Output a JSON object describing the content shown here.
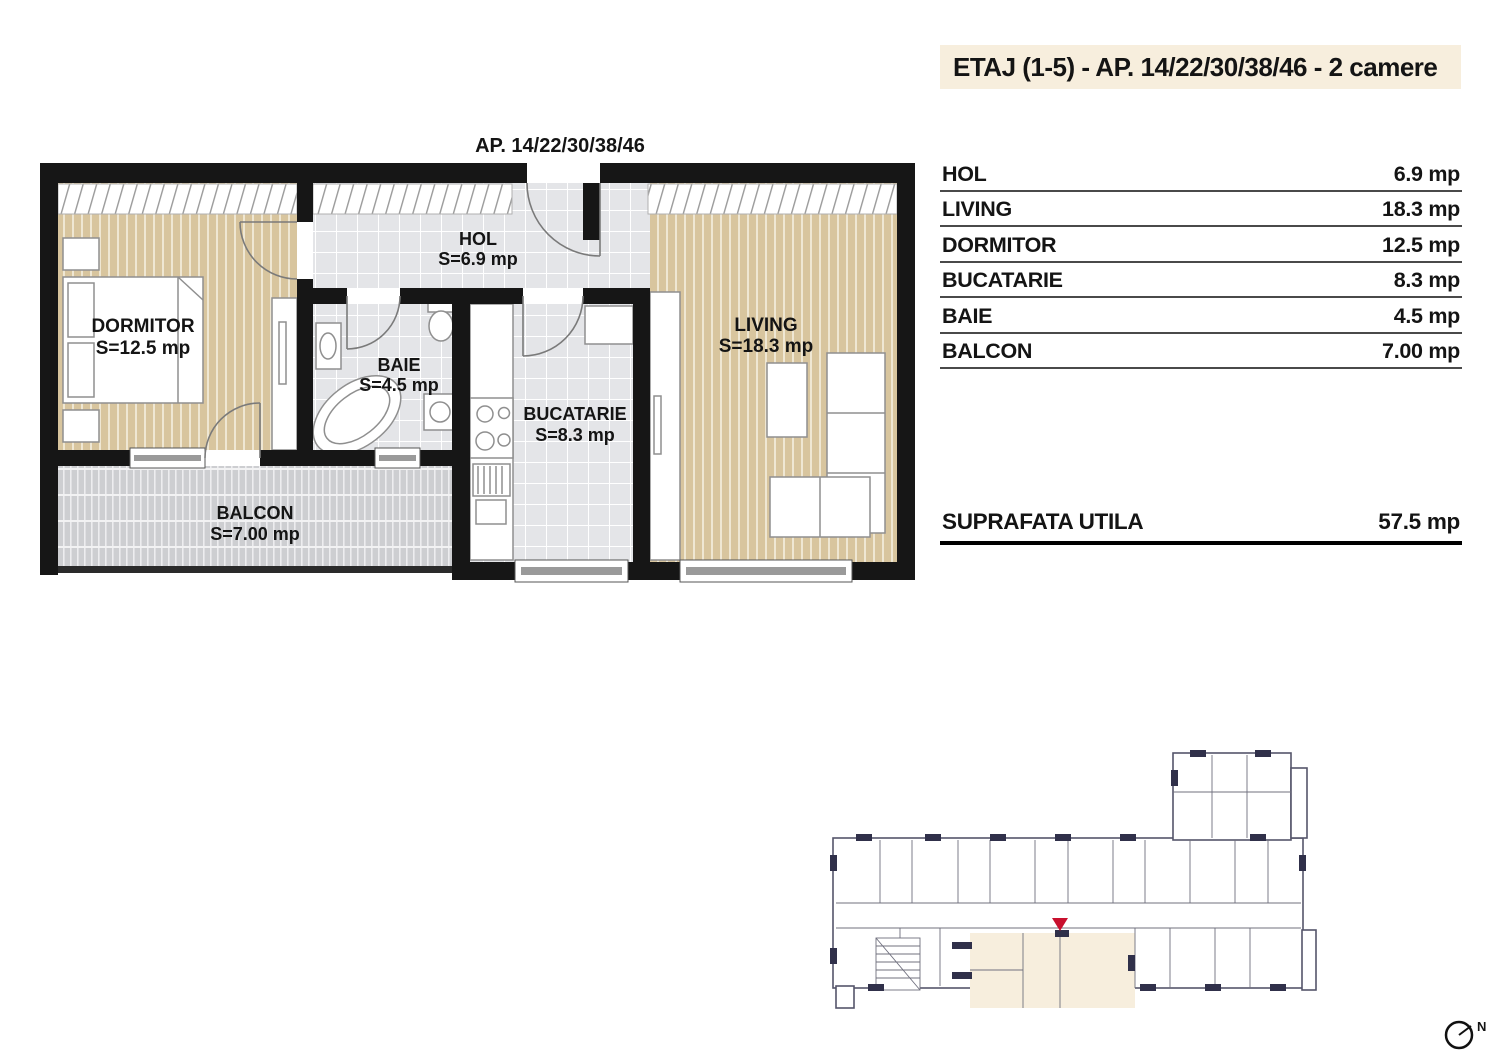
{
  "header": {
    "title": "ETAJ (1-5) - AP. 14/22/30/38/46 - 2 camere"
  },
  "plan": {
    "title": "AP. 14/22/30/38/46",
    "rooms": [
      {
        "id": "dormitor",
        "label": "DORMITOR",
        "area": "S=12.5 mp"
      },
      {
        "id": "baie",
        "label": "BAIE",
        "area": "S=4.5 mp"
      },
      {
        "id": "hol",
        "label": "HOL",
        "area": "S=6.9 mp"
      },
      {
        "id": "bucatarie",
        "label": "BUCATARIE",
        "area": "S=8.3 mp"
      },
      {
        "id": "living",
        "label": "LIVING",
        "area": "S=18.3 mp"
      },
      {
        "id": "balcon",
        "label": "BALCON",
        "area": "S=7.00 mp"
      }
    ]
  },
  "table": {
    "rows": [
      {
        "label": "HOL",
        "value": "6.9 mp"
      },
      {
        "label": "LIVING",
        "value": "18.3 mp"
      },
      {
        "label": "DORMITOR",
        "value": "12.5 mp"
      },
      {
        "label": "BUCATARIE",
        "value": "8.3 mp"
      },
      {
        "label": "BAIE",
        "value": "4.5 mp"
      },
      {
        "label": "BALCON",
        "value": "7.00 mp"
      }
    ],
    "total": {
      "label": "SUPRAFATA UTILA",
      "value": "57.5 mp"
    }
  },
  "minimap": {
    "north_label": "N"
  },
  "colors": {
    "cream": "#f7eedd",
    "wood": "#d8c59e",
    "tile": "#e4e5e8",
    "deck": "#cdced1",
    "wall": "#161616",
    "marker_red": "#c8102e",
    "keyplan_wall": "#30304a",
    "text": "#141414"
  }
}
